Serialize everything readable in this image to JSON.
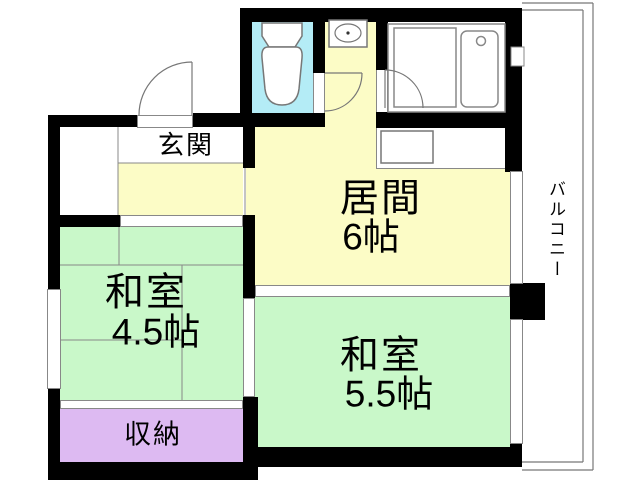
{
  "rooms": {
    "genkan": {
      "label": "玄関"
    },
    "living": {
      "label": "居間",
      "size": "6帖"
    },
    "washitsu_small": {
      "label": "和室",
      "size": "4.5帖"
    },
    "washitsu_large": {
      "label": "和室",
      "size": "5.5帖"
    },
    "storage": {
      "label": "収納"
    },
    "balcony": {
      "label": "バルコニー"
    }
  },
  "colors": {
    "wall": "#000000",
    "wood_floor": "#fcfcc6",
    "tatami": "#c9f8c9",
    "toilet_room": "#b4ecf6",
    "storage_fill": "#ddbaf2",
    "thin_line": "#888888",
    "fixture_line": "#777777"
  }
}
